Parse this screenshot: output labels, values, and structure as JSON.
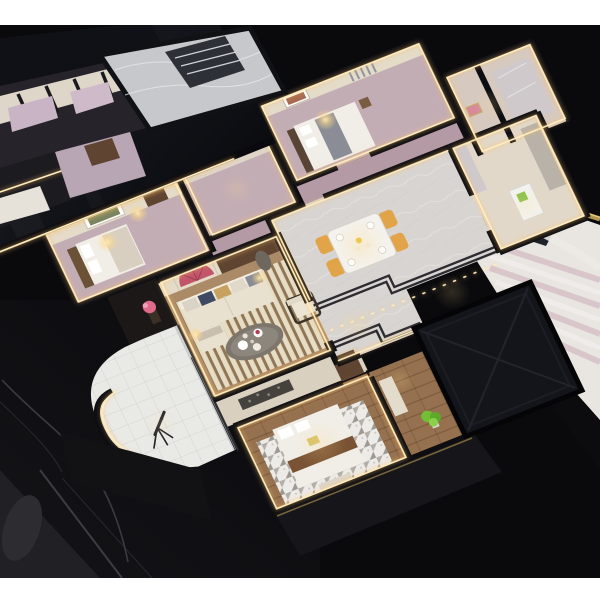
{
  "scene": {
    "title": "Aerial photograph of a miniature apartment scale model",
    "medium": "photograph",
    "description": "Dollhouse-style cutaway architectural model of an apartment interior, shot from a high oblique angle. Rooms are framed by black wall tops edged with warm LED strips and sit on a glossy black base. White letterbox bands appear at the top and bottom of the frame.",
    "letterbox": {
      "top_px": 25,
      "bottom_px": 22
    }
  },
  "palette": {
    "background": "#0a0a0d",
    "letterbox": "#ffffff",
    "roof_glass_dark": "#0b0c10",
    "roof_glass_light": "#1d1f28",
    "panel_navy": "#14151b",
    "wall_black": "#0e0e12",
    "wall_top": "#17171b",
    "led_warm": "#ffedbe",
    "lamp_warm": "#ffd98e",
    "wall_cream": "#e4dbc9",
    "wall_wood": "#5f4531",
    "curtain_grey": "#9aa0ab",
    "floor_mauve": "#c3adb4",
    "floor_mauve_dark": "#b49aa4",
    "floor_marble": "#d8d4d1",
    "floor_wood": "#96714f",
    "floor_wood_dark": "#7b593c",
    "floor_tile": "#e9e9e6",
    "rug_light": "#e7dcc4",
    "rug_dark": "#8f7656",
    "rug_white": "#edebe7",
    "sofa_cream": "#e9e1d0",
    "sofa_back": "#f2ecdf",
    "cushion_navy": "#3e4a64",
    "cushion_tan": "#c7a15e",
    "cushion_grey": "#8a8d96",
    "table_oval": "#7d766c",
    "chair_yellow": "#e2a449",
    "table_white": "#f4f2ee",
    "fan_art": "#c2556a",
    "flower_pink": "#e06a8a",
    "plant_green": "#72bf35",
    "sculpture_grey": "#6e675e",
    "bed_white": "#f1eee8",
    "runner_brown": "#7a5334",
    "gold_item": "#d6c268",
    "fridge_white": "#f2f2ef",
    "fridge_green": "#8ac24a",
    "stairs_white": "#e9e6e2",
    "stairs_pink": "#d9c6cb",
    "brass": "#b5954f",
    "marble_wall": "#cfc9cc",
    "console_dark": "#1b1817",
    "neighbor_lavender": "#c9b4c6",
    "base_grey": "#212125",
    "cable_grey": "#45464c"
  },
  "rooms": [
    {
      "id": "west-bedroom",
      "label": "West bedroom",
      "items": [
        "bed with dark headboard",
        "two glowing bedside lamps",
        "framed abstract art",
        "wood door",
        "LED cove lighting"
      ]
    },
    {
      "id": "small-mauve-room",
      "label": "Empty room with mauve floor",
      "items": [
        "LED cove lighting"
      ]
    },
    {
      "id": "north-bedroom",
      "label": "North bedroom",
      "items": [
        "bed with grey throw",
        "warm table lamp",
        "grey curtains",
        "framed art"
      ]
    },
    {
      "id": "living-room",
      "label": "Living room",
      "items": [
        "cream sofa with navy and tan cushions",
        "striped slat rug",
        "oval coffee table with dishes",
        "armchair",
        "pink fan-shaped wall art",
        "grey sculpture",
        "pink lotus flower on dark console"
      ]
    },
    {
      "id": "dining-room",
      "label": "Dining room",
      "items": [
        "white dining table",
        "four amber-yellow chairs",
        "place settings",
        "yellow flower centerpiece",
        "marble floor with stepped black inlay lines"
      ]
    },
    {
      "id": "kitchen-bath",
      "label": "Kitchen / bathroom block",
      "items": [
        "white refrigerator with green box",
        "marble wall panels",
        "counter"
      ]
    },
    {
      "id": "north-east-room",
      "label": "Upper-right washroom",
      "items": [
        "marble shower block",
        "small pink artwork"
      ]
    },
    {
      "id": "south-bedroom",
      "label": "South bedroom",
      "items": [
        "white bed with brown runner",
        "gold clutch on bed",
        "geometric grey-triangle rug",
        "wood plank floor",
        "dresser with dark patterned art",
        "green plant",
        "bench"
      ]
    },
    {
      "id": "balcony",
      "label": "Curved balcony",
      "items": [
        "white tile floor",
        "telescope on tripod",
        "glass doors"
      ]
    },
    {
      "id": "staircase",
      "label": "Staircase (adjacent unit)",
      "items": [
        "white platform",
        "pink treads",
        "brass handrail"
      ]
    },
    {
      "id": "roof-panels",
      "label": "Dark glass roof panels",
      "items": [
        "large glossy panel over north-west rooms",
        "matte navy square panel with X crease over entry"
      ]
    },
    {
      "id": "neighbor-unit",
      "label": "Neighbouring model unit (top-left edge)",
      "items": [
        "lavender rooms",
        "striped walls",
        "marble lobby sliver with dark stair"
      ]
    }
  ],
  "base": {
    "label": "Glossy black display base",
    "details": [
      "faint reflections",
      "thin cable on the left",
      "grey sheen at bottom-left corner"
    ]
  }
}
